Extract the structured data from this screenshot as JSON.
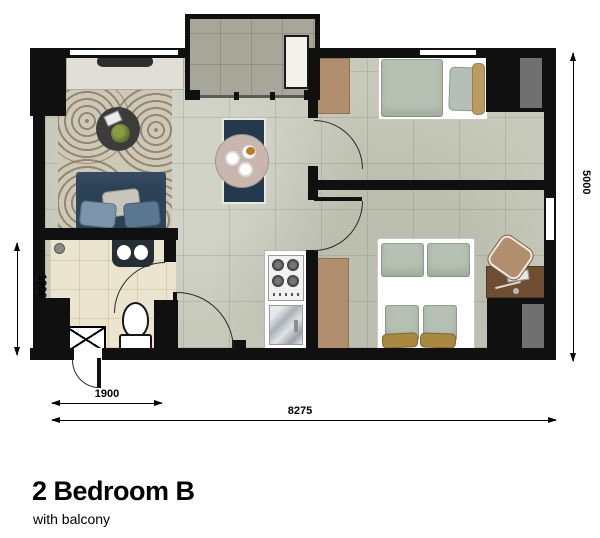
{
  "plan": {
    "title": "2 Bedroom B",
    "subtitle": "with balcony",
    "rooms": [
      "balcony",
      "living-dining",
      "bedroom-1",
      "bedroom-2",
      "bathroom",
      "kitchen",
      "entry-corridor"
    ],
    "dimensions": {
      "left_vertical": "1900",
      "bottom_partial": "1900",
      "bottom_total": "8275",
      "right_vertical": "5000"
    },
    "colors": {
      "wall": "#101010",
      "floor_tile": "#c7c9bb",
      "balcony_tile": "#a7a799",
      "bathroom_tile": "#ebe5d0",
      "sofa_navy": "#2b4156",
      "runner_navy": "#24384e",
      "wood_tan": "#b18e6e",
      "closet_gray": "#707070",
      "bed_sage": "#b6c1b3",
      "pillow_tan": "#bd9b61",
      "desk_brown": "#6e4e33",
      "dining_table": "#c9b7ad"
    }
  }
}
